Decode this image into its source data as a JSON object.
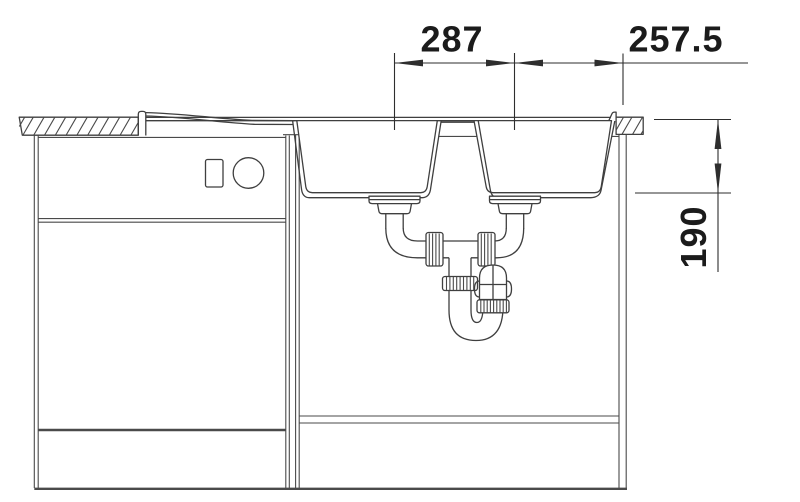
{
  "dimensions": {
    "bowl_center_distance": "287",
    "right_edge_distance": "257.5",
    "bowl_depth": "190"
  },
  "colors": {
    "background": "#ffffff",
    "line": "#3f3f3f",
    "dimension_text": "#1b1b1b"
  }
}
